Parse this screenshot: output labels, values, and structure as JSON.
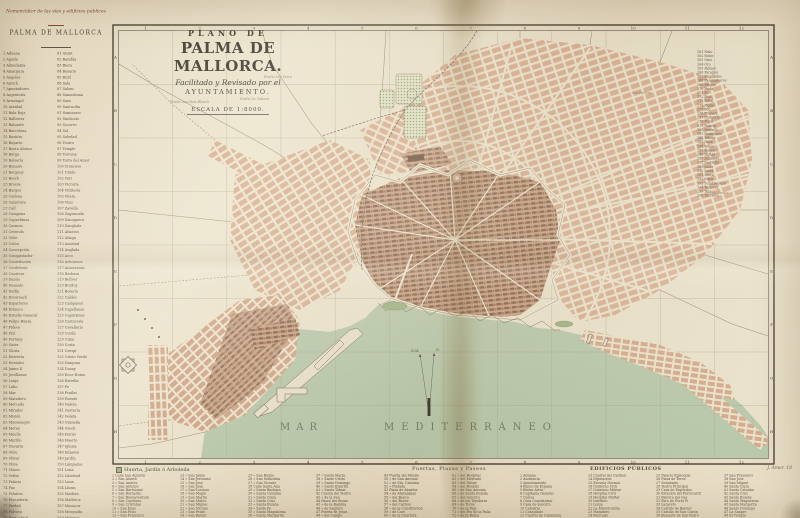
{
  "header": {
    "nomenclator": "Nomenclátor de las vías y edificios públicos",
    "city": "PALMA DE MALLORCA"
  },
  "title_block": {
    "line1": "PLANO DE",
    "line2": "PALMA DE MALLORCA.",
    "line3": "Facilitado y Revisado por el",
    "line4": "AYUNTAMIENTO.",
    "scale": "ESCALA DE 1:8000."
  },
  "map": {
    "sea_label_word1": "MAR",
    "sea_label_word2": "MEDITERRÁNEO",
    "compass_nm": "N.M.",
    "compass_n": "N.",
    "grid_numbers": [
      "1",
      "2",
      "3",
      "4",
      "5",
      "6",
      "7",
      "8",
      "9",
      "10",
      "11",
      "12"
    ],
    "grid_letters": [
      "A",
      "B",
      "C",
      "D",
      "E",
      "F",
      "G",
      "H"
    ],
    "place_labels": [
      {
        "text": "Predio Son Moix Blanch"
      },
      {
        "text": "Predio La Cabana"
      },
      {
        "text": "Predio Son Serra"
      },
      {
        "text": "Son Fortesa"
      },
      {
        "text": "Son Canals"
      }
    ]
  },
  "left_index": {
    "col1": [
      "1 Aduana",
      "2 Aguila",
      "3 Almudaina",
      "4 Amargura",
      "5 Angeles",
      "6 Antich",
      "7 Apuntadores",
      "8 Argentería",
      "9 Armengol",
      "10 Arrabal",
      "11 Bala Roja",
      "12 Ballester",
      "13 Baluarte",
      "14 Barcelona",
      "15 Bastión",
      "16 Bayarte",
      "17 Beato Alonso",
      "18 Berga",
      "19 Bolsería",
      "20 Bonaire",
      "21 Borguny",
      "22 Bosch",
      "23 Brossa",
      "24 Burgos",
      "25 Cadena",
      "26 Calatrava",
      "27 Call",
      "28 Campana",
      "29 Capuchinas",
      "30 Carmen",
      "31 Cererols",
      "32 Cifre",
      "33 Colón",
      "34 Concepción",
      "35 Conquistador",
      "36 Constitución",
      "37 Cordelería",
      "38 Cuartera",
      "39 Danús",
      "40 Deanato",
      "41 Delfín",
      "42 Escursach",
      "43 Esparteros",
      "44 Estanco",
      "45 Estudio General",
      "46 Felipe Bauzá",
      "47 Fideos",
      "48 Fiol",
      "49 Fortuny",
      "50 Gater",
      "51 Gloria",
      "52 Herrería",
      "53 Hostales",
      "54 Jaime II",
      "55 Jovellanos",
      "56 Lonja",
      "57 Lulio",
      "58 Mar",
      "59 Matadero",
      "60 Mercado",
      "61 Mirador",
      "62 Misión",
      "63 Montenegro",
      "64 Morey",
      "65 Muelle",
      "66 Murillo",
      "67 Navarra",
      "68 Odre",
      "69 Olivar",
      "70 Oliva",
      "71 Olmos",
      "72 Orfila",
      "73 Palacio",
      "74 Paz",
      "75 Pelaires",
      "76 Pescadería",
      "77 Piedad",
      "78 Pólvora",
      "79 Pont y Vich",
      "80 Pueyo"
    ],
    "col2": [
      "81 Quint",
      "82 Rambla",
      "83 Riera",
      "84 Rosario",
      "85 Rubí",
      "86 Sala",
      "87 Salom",
      "88 Samaritana",
      "89 Sans",
      "90 Santacilia",
      "91 Seminario",
      "92 Sindicato",
      "93 Socorro",
      "94 Sol",
      "95 Soledad",
      "96 Teatro",
      "97 Temple",
      "98 Tercena",
      "99 Torre del Amor",
      "100 Troncoso",
      "101 Unión",
      "102 Veri",
      "103 Victoria",
      "104 Vidriería",
      "105 Vileta",
      "106 Vino",
      "107 Zavellá",
      "108 Zagranada",
      "109 Zanoguera",
      "110 Zanglada",
      "111 Abastos",
      "112 Aliaga",
      "113 Amistad",
      "114 Anglada",
      "115 Arco",
      "116 Artesanos",
      "117 Atarazanas",
      "118 Bárbara",
      "119 Bellver",
      "120 Bordoy",
      "121 Botería",
      "122 Caldés",
      "123 Campaner",
      "124 Capellanes",
      "125 Caputxines",
      "126 Carnicería",
      "127 Cavallería",
      "128 Cerdá",
      "129 Cima",
      "130 Costa",
      "131 Crespí",
      "132 Cristo Verde",
      "133 Dragona",
      "134 Dusay",
      "135 Ecce-Homo",
      "136 Estrella",
      "137 Fe",
      "138 Frailes",
      "139 Fuente",
      "140 Galera",
      "141 Gerrería",
      "142 Goleta",
      "143 Granada",
      "144 Grech",
      "145 Horno",
      "146 Huerto",
      "147 Iglesia",
      "148 Infantes",
      "149 Jardín",
      "150 Lámparas",
      "151 Leña",
      "152 Libertad",
      "153 Luna",
      "154 Llums",
      "155 Madera",
      "156 Mallorca",
      "157 Manacor",
      "158 Mesquida",
      "159 Miñonas",
      "160 Molineros"
    ]
  },
  "right_index": {
    "entries": [
      "161 Niño",
      "162 Nube",
      "163 Oms",
      "164 Oro",
      "165 Palmer",
      "166 Paraires",
      "167 Parellades",
      "168 Pasamaneros",
      "169 Peligro",
      "170 Perla",
      "171 Pí",
      "172 Picó",
      "173 Pilón",
      "174 Plomo",
      "175 Pou",
      "176 Prevera",
      "177 Protectora",
      "178 Pujol",
      "179 Puresa",
      "180 Reixach",
      "181 Remolares",
      "182 Ribera",
      "183 Roca",
      "184 Roser",
      "185 Rossiñol",
      "186 Rutlán",
      "187 Sabaters",
      "188 Sacristía",
      "189 Salas",
      "190 Salvá",
      "191 Serra",
      "192 Sitjar",
      "193 Sombrereros",
      "194 Tamorer",
      "195 Teix",
      "196 Terrassa"
    ]
  },
  "bottom_index": {
    "legend_left": "Huerta, Jardín ó Arboleda",
    "legend_center": "Puertas, Plazas y Paseos",
    "edificios_header": "EDIFICIOS PÚBLICOS",
    "signature": "J. Amer. 18",
    "columns": [
      [
        "1 Calle San Agustín",
        "2 »  San Alonso",
        "3 »  San Andrés",
        "4 »  San Antonio",
        "5 »  San Bartolomé",
        "6 »  San Bernardo",
        "7 »  San Buenaventura",
        "8 »  San Cayetano",
        "9 »  San Cristóbal",
        "10 »  San Elías",
        "11 »  San Felio",
        "12 »  San Francisco"
      ],
      [
        "13 »  San Jaime",
        "14 »  San Jerónimo",
        "15 »  San José",
        "16 »  San Juan",
        "17 »  San Lorenzo",
        "18 »  San Magín",
        "19 »  San Martín",
        "20 »  San Mateo",
        "21 »  San Miguel",
        "22 »  San Nicolás",
        "23 »  San Pedro",
        "24 »  San Rafael"
      ],
      [
        "25 »  San Roque",
        "26 »  San Sebastián",
        "27 »  San Vicente",
        "28 Calle Santa Ana",
        "29 »  Santa Bárbara",
        "30 »  Santa Catalina",
        "31 »  Santa Clara",
        "32 »  Santa Cruz",
        "33 »  Santa Eulalia",
        "34 »  Santa Fe",
        "35 »  Santa Magdalena",
        "36 »  Santa Margarita"
      ],
      [
        "37 »  Santa María",
        "38 »  Santo Cristo",
        "39 »  Santo Domingo",
        "40 »  Santo Espíritu",
        "41 »  Santo Tomás",
        "42 Cuesta del Teatro",
        "43 »  de la Seo",
        "44 Paseo del Borne",
        "45 »  de la Rambla",
        "46 »  de Sagrera",
        "47 Puerta de Jesús",
        "48 »  del Campo"
      ],
      [
        "49 Puerta del Muelle",
        "50 »  de San Antonio",
        "51 »  de Sta. Catalina",
        "52 »  Pintada",
        "53 Plaza de Abastos",
        "54 »  de Atarazanas",
        "55 »  del Banco",
        "56 »  del Borne",
        "57 »  del Carbón",
        "58 »  de la Constitución",
        "59 »  de Cort",
        "60 »  de la Cuartera"
      ],
      [
        "61 »  del Hospital",
        "62 »  del Mercado",
        "63 »  del Olivar",
        "64 »  del Rosario",
        "65 »  de San Antonio",
        "66 »  de Santa Eulalia",
        "67 »  del Socorro",
        "68 »  de los Tejedores",
        "69 »  de Toros",
        "70 »  de la Paja",
        "71 »  del Pes de la Palla",
        "72 »  de la Reina"
      ],
      [
        "1 Aduana",
        "2 Audiencia",
        "3 Ayuntamiento",
        "4 Banco de España",
        "5 Bellas Artes",
        "6 Capitanía General",
        "7 Cárcel",
        "8 Casa Consistorial",
        "9 Casa de Socorro",
        "10 Catedral",
        "11 Consulado",
        "12 Cuartel de Caballería"
      ],
      [
        "13 Cuartel del Carmen",
        "14 Diputación",
        "15 Escuela Normal",
        "16 Gobierno Civil",
        "17 Gobierno Militar",
        "18 Hospital Civil",
        "19 Hospital Militar",
        "20 Instituto",
        "21 Lonja",
        "22 La Misericordia",
        "23 Matadero",
        "24 Mercado"
      ],
      [
        "25 Palacio Episcopal",
        "26 Plaza de Toros",
        "27 Seminario",
        "28 Teatro Principal",
        "29 Casa de Expósitos",
        "30 Estación del Ferrocarril",
        "31 Fábrica del Gas",
        "32 Faro de Porto Pí",
        "33 Lazareto",
        "34 Castillo de Bellver",
        "35 Castillo de San Carlos",
        "36 Baluarte de San Pedro"
      ],
      [
        "37 San Francisco",
        "38 San José",
        "39 San Miguel",
        "40 Santa Clara",
        "41 Santa Catalina",
        "42 Santa Cruz",
        "43 Santa Eulalia",
        "44 Santa Magdalena",
        "45 Santa Margarita",
        "46 Santo Domingo",
        "47 La Sangre",
        "48 El Temple"
      ]
    ]
  }
}
